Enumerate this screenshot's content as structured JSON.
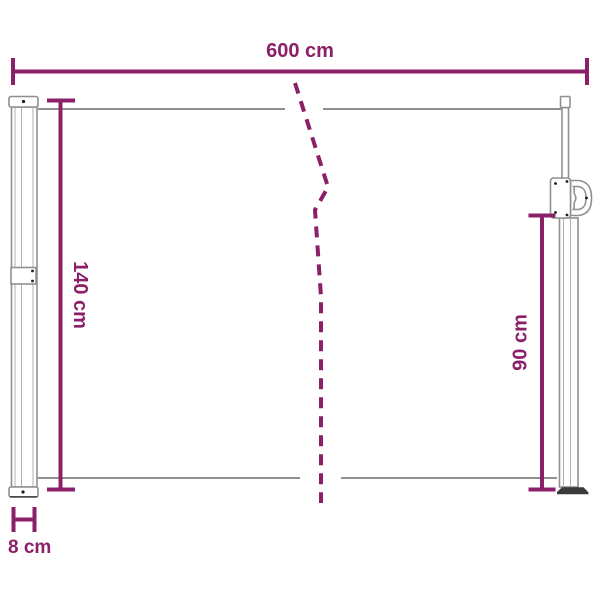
{
  "diagram": {
    "type": "product-dimension-drawing",
    "labels": {
      "width": "600 cm",
      "height_left": "140 cm",
      "height_right": "90 cm",
      "depth": "8 cm"
    },
    "colors": {
      "dimension": "#8B2069",
      "structure": "#8F8F8F",
      "structure_light": "#B0B0B0",
      "foot": "#3A3A3A",
      "background": "#FFFFFF"
    }
  }
}
